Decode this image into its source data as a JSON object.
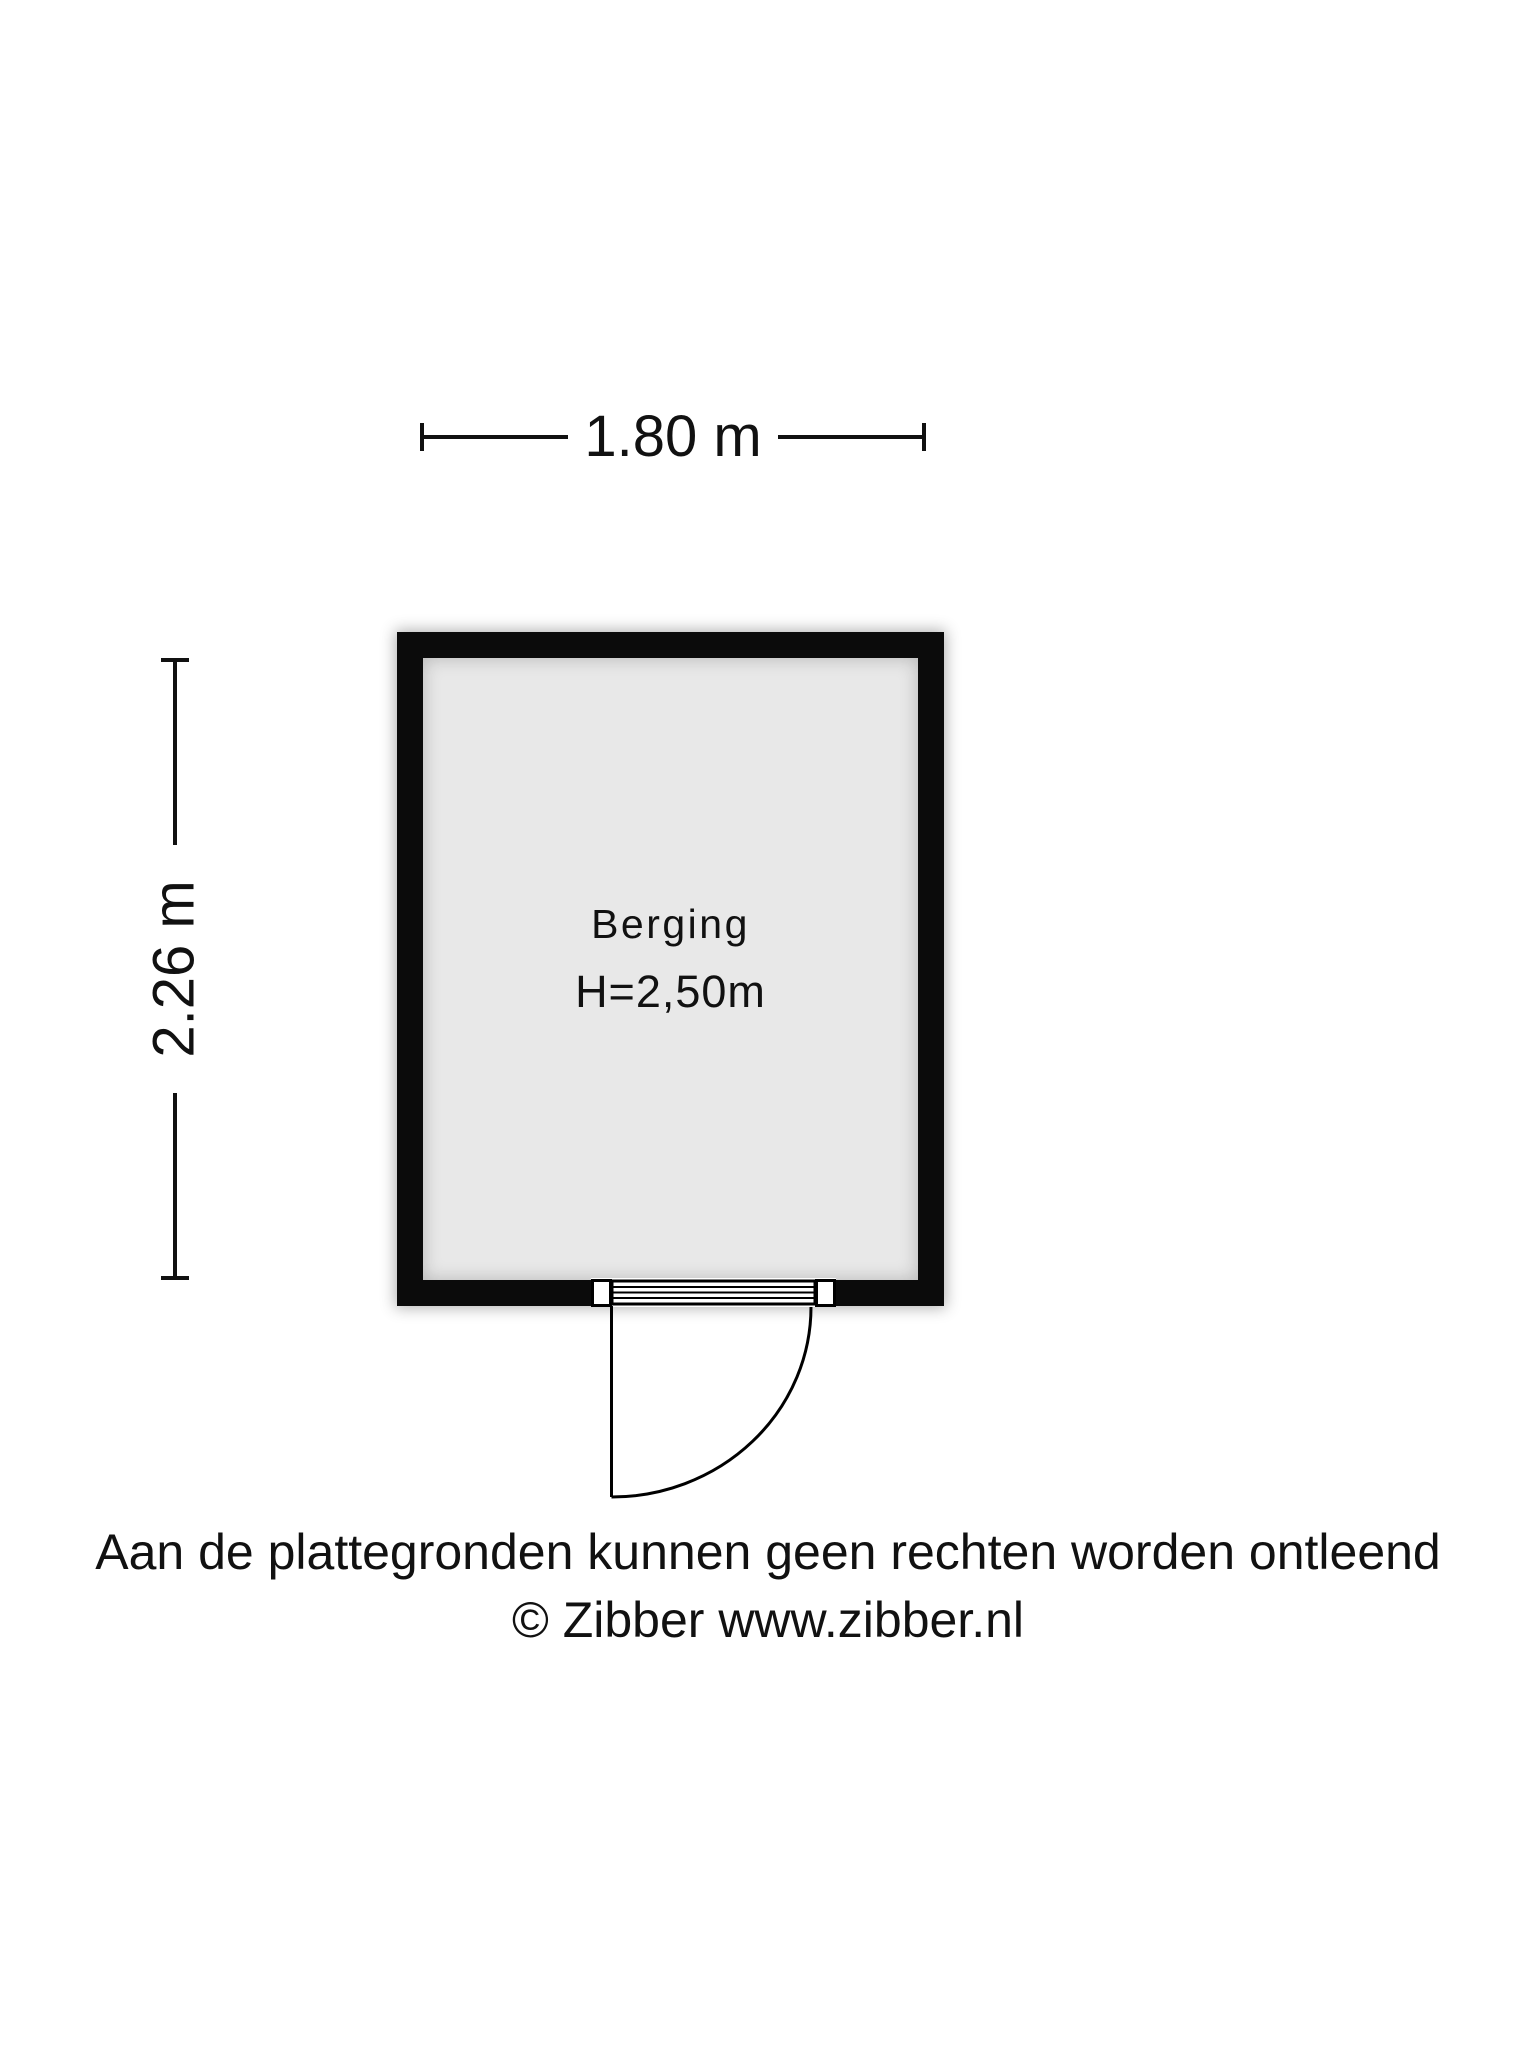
{
  "floorplan": {
    "dimensions": {
      "width_label": "1.80 m",
      "height_label": "2.26 m"
    },
    "room": {
      "name": "Berging",
      "ceiling_height": "H=2,50m"
    },
    "colors": {
      "wall": "#0b0b0b",
      "floor": "#e8e8e8",
      "line": "#111111"
    }
  },
  "footer": {
    "disclaimer": "Aan de plattegronden kunnen geen rechten worden ontleend",
    "copyright": "© Zibber www.zibber.nl"
  }
}
